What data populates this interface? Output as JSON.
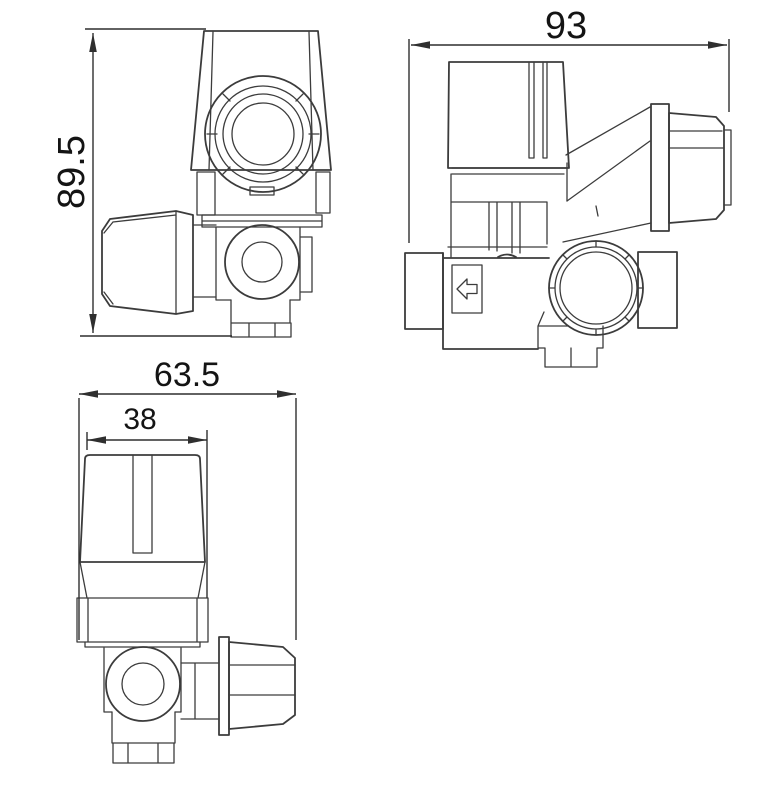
{
  "colors": {
    "background": "#ffffff",
    "line": "#3c3c3c",
    "dimension_line": "#2f2f2f",
    "dimension_text": "#141414"
  },
  "dimensions": {
    "overall_height": "89.5",
    "overall_length": "93",
    "overall_width": "63.5",
    "knob_width": "38"
  },
  "icons": {
    "flow_direction_arrow": "left-arrow"
  }
}
